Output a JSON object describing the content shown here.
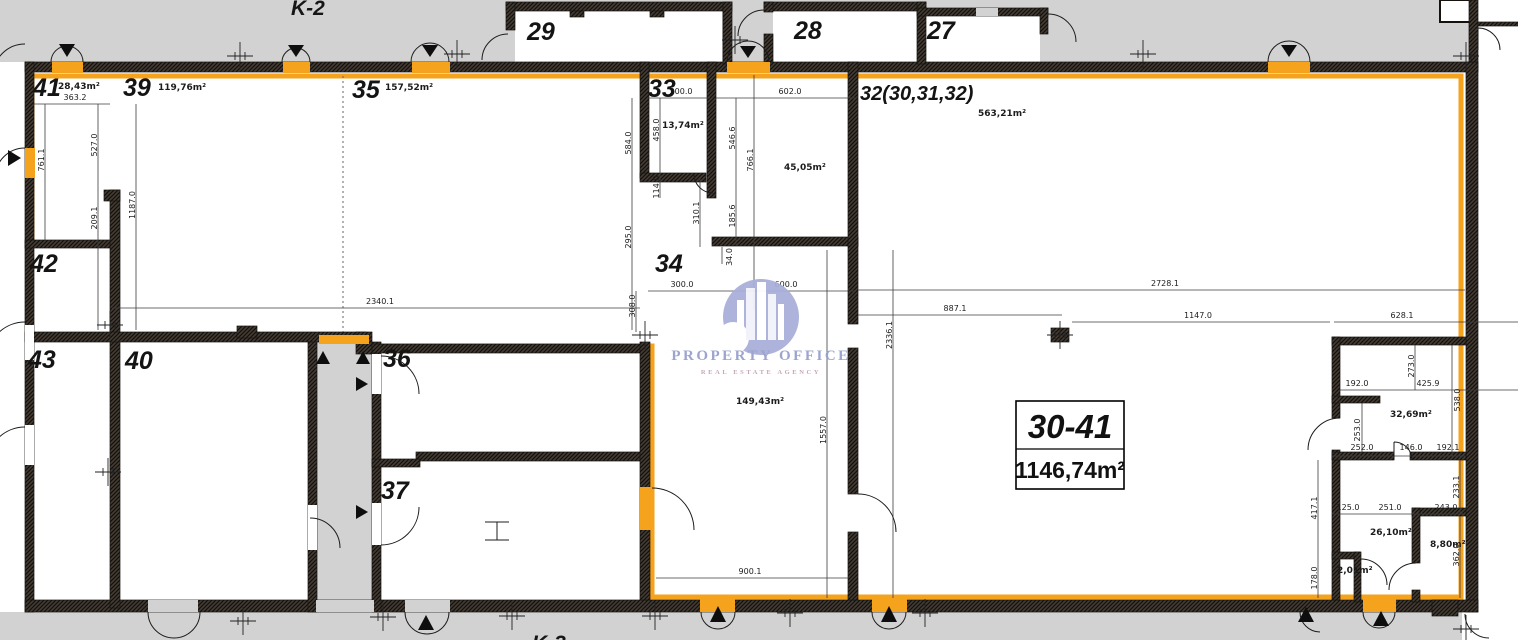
{
  "plan": {
    "zone_labels": {
      "top": "K-2",
      "bottom": "K-3"
    },
    "summary": {
      "units": "30-41",
      "total_area": "1146,74m²"
    },
    "logo": {
      "name": "PROPERTY OFFICE",
      "tagline": "REAL ESTATE AGENCY"
    },
    "rooms": {
      "r41": {
        "number": "41",
        "area": "28,43m²"
      },
      "r39": {
        "number": "39",
        "area": "119,76m²"
      },
      "r35": {
        "number": "35",
        "area": "157,52m²"
      },
      "r33": {
        "number": "33",
        "area": "13,74m²"
      },
      "r32": {
        "number": "32(30,31,32)",
        "area": "563,21m²"
      },
      "r34": {
        "number": "34",
        "area": "149,43m²"
      },
      "r31": {
        "area": "45,05m²"
      },
      "rA": {
        "area": "32,69m²"
      },
      "rB": {
        "area": "26,10m²"
      },
      "rC": {
        "area": "8,80m²"
      },
      "rD": {
        "area": "2,01m²"
      },
      "r42": {
        "number": "42"
      },
      "r43": {
        "number": "43"
      },
      "r40": {
        "number": "40"
      },
      "r36": {
        "number": "36"
      },
      "r37": {
        "number": "37"
      },
      "r29": {
        "number": "29"
      },
      "r28": {
        "number": "28"
      },
      "r27": {
        "number": "27"
      }
    },
    "dims": [
      "363.2",
      "527.0",
      "761.1",
      "1187.0",
      "209.1",
      "2340.1",
      "300.0",
      "602.0",
      "584.0",
      "458.0",
      "546.6",
      "766.1",
      "114.0",
      "310.1",
      "185.6",
      "295.0",
      "34.0",
      "300.0",
      "600.0",
      "308.0",
      "2728.1",
      "887.1",
      "1147.0",
      "628.1",
      "2336.1",
      "1557.0",
      "900.1",
      "192.0",
      "273.0",
      "425.9",
      "538.0",
      "253.0",
      "252.0",
      "146.0",
      "192.1",
      "233.1",
      "125.0",
      "251.0",
      "243.0",
      "417.1",
      "178.0",
      "362.0"
    ]
  }
}
